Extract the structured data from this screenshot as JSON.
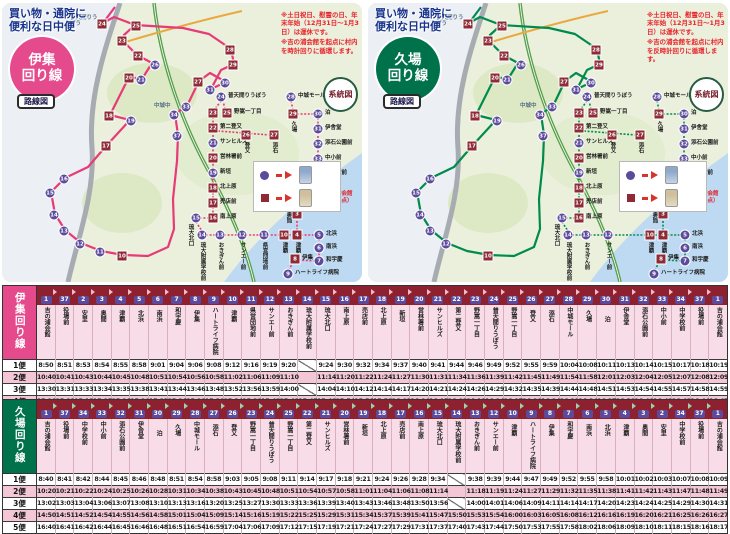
{
  "shared": {
    "tagline_line1": "買い物・通院に",
    "tagline_line2": "便利な日中便",
    "route_map_chip": "路線図",
    "system_chip": "系統図",
    "note_common": "※土日祝日、慰霊の日、年末年始（12月31日～1月3日）は運休です。"
  },
  "stops": {
    "1": "吉の浦会館",
    "2": "安里",
    "3": "奥間",
    "4": "津覇",
    "5": "北浜",
    "6": "南浜",
    "7": "和宇慶",
    "8": "伊集",
    "9": "ハートライフ病院",
    "10": "津覇",
    "11": "県営団地前",
    "12": "サンエー前",
    "13": "おきぎん前",
    "14": "琉大附属学校前",
    "15": "琉大北口",
    "16": "南上原",
    "17": "売店前",
    "18": "北上原",
    "19": "新垣",
    "20": "営林署前",
    "21": "サンヒルズ",
    "22": "第二登又",
    "23": "野嵩一丁目",
    "24": "普天間りうぼう",
    "25": "野嵩一丁目",
    "26": "登又",
    "27": "添石",
    "28": "中城モール",
    "29": "久場",
    "30": "泊",
    "31": "伊舎堂",
    "32": "添石公園前",
    "33": "中小前",
    "34": "中学校前",
    "37": "役場前"
  },
  "maps": [
    {
      "badge_line1": "伊集",
      "badge_line2": "回り線",
      "accent": "#e44a8c",
      "route_color": "#e73a77",
      "note_loop": "※吉の浦会館を起点に村内を時計回りに循環します。",
      "terminal": "吉の浦会館（起終点）",
      "geo_labels": [
        "普天間りうぼう",
        "中城中"
      ],
      "skip_stops": []
    },
    {
      "badge_line1": "久場",
      "badge_line2": "回り線",
      "accent": "#00724b",
      "route_color": "#008a4e",
      "note_loop": "※吉の浦会館を起点に村内を反時計回りに循環します。",
      "terminal": "吉の浦会館（起終点）",
      "geo_labels": [
        "普天間りうぼう",
        "中城中"
      ],
      "skip_stops": [
        "11"
      ]
    }
  ],
  "timetables": [
    {
      "line": "伊集回り線",
      "accent": "#e44a8c",
      "arrow_color": "#f2b9c6",
      "column_numbers": [
        "1",
        "37",
        "2",
        "3",
        "4",
        "5",
        "6",
        "7",
        "8",
        "9",
        "10",
        "11",
        "12",
        "13",
        "14",
        "15",
        "16",
        "17",
        "18",
        "19",
        "20",
        "21",
        "22",
        "23",
        "24",
        "25",
        "26",
        "27",
        "28",
        "29",
        "30",
        "31",
        "32",
        "33",
        "34",
        "37",
        "1"
      ],
      "trips": [
        {
          "label": "1便",
          "times": [
            "8:50",
            "8:51",
            "8:53",
            "8:54",
            "8:55",
            "8:58",
            "9:01",
            "9:04",
            "9:06",
            "9:08",
            "9:12",
            "9:16",
            "9:19",
            "9:20",
            "/",
            "9:24",
            "9:30",
            "9:32",
            "9:34",
            "9:37",
            "9:40",
            "9:41",
            "9:44",
            "9:46",
            "9:49",
            "9:52",
            "9:55",
            "9:59",
            "10:04",
            "10:08",
            "10:11",
            "10:13",
            "10:14",
            "10:15",
            "10:17",
            "10:18",
            "10:19"
          ]
        },
        {
          "label": "2便",
          "times": [
            "10:40",
            "10:41",
            "10:43",
            "10:44",
            "10:45",
            "10:48",
            "10:51",
            "10:54",
            "10:56",
            "10:58",
            "11:02",
            "11:06",
            "11:09",
            "11:10",
            "/",
            "11:14",
            "11:20",
            "11:22",
            "11:24",
            "11:27",
            "11:30",
            "11:31",
            "11:34",
            "11:36",
            "11:39",
            "11:42",
            "11:45",
            "11:49",
            "11:54",
            "11:58",
            "12:01",
            "12:03",
            "12:04",
            "12:05",
            "12:07",
            "12:08",
            "12:09"
          ]
        },
        {
          "label": "3便",
          "times": [
            "13:30",
            "13:31",
            "13:33",
            "13:34",
            "13:35",
            "13:38",
            "13:41",
            "13:44",
            "13:46",
            "13:48",
            "13:52",
            "13:56",
            "13:59",
            "14:00",
            "/",
            "14:04",
            "14:10",
            "14:12",
            "14:14",
            "14:17",
            "14:20",
            "14:21",
            "14:24",
            "14:26",
            "14:29",
            "14:32",
            "14:35",
            "14:39",
            "14:44",
            "14:48",
            "14:51",
            "14:53",
            "14:54",
            "14:55",
            "14:57",
            "14:58",
            "14:59"
          ]
        },
        {
          "label": "4便",
          "times": [
            "15:10",
            "15:11",
            "15:13",
            "15:15",
            "15:16",
            "15:20",
            "15:23",
            "15:26",
            "15:28",
            "15:30",
            "15:34",
            "15:38",
            "15:41",
            "15:42",
            "15:45",
            "15:48",
            "15:54",
            "15:56",
            "15:58",
            "16:01",
            "16:04",
            "16:05",
            "16:08",
            "16:11",
            "16:14",
            "16:17",
            "16:20",
            "16:24",
            "16:29",
            "16:34",
            "16:37",
            "16:39",
            "16:40",
            "16:41",
            "16:43",
            "16:44",
            "16:45"
          ]
        },
        {
          "label": "5便",
          "times": [
            "17:05",
            "17:06",
            "/",
            "/",
            "/",
            "/",
            "/",
            "/",
            "/",
            "/",
            "/",
            "17:11",
            "17:14",
            "17:15",
            "17:18",
            "17:21",
            "17:27",
            "17:29",
            "17:31",
            "17:34",
            "17:37",
            "17:39",
            "17:42",
            "17:45",
            "17:48",
            "17:51",
            "17:54",
            "17:58",
            "18:03",
            "18:08",
            "18:11",
            "18:13",
            "18:14",
            "18:15",
            "18:17",
            "18:18",
            "18:19"
          ]
        }
      ]
    },
    {
      "line": "久場回り線",
      "accent": "#00724b",
      "arrow_color": "#9ed1ae",
      "column_numbers": [
        "1",
        "37",
        "34",
        "33",
        "32",
        "31",
        "30",
        "29",
        "28",
        "27",
        "26",
        "23",
        "24",
        "25",
        "22",
        "21",
        "20",
        "19",
        "18",
        "17",
        "16",
        "15",
        "14",
        "13",
        "12",
        "10",
        "9",
        "8",
        "7",
        "6",
        "5",
        "4",
        "3",
        "2",
        "34",
        "37",
        "1"
      ],
      "trips": [
        {
          "label": "1便",
          "times": [
            "8:40",
            "8:41",
            "8:42",
            "8:44",
            "8:45",
            "8:46",
            "8:48",
            "8:51",
            "8:54",
            "8:58",
            "9:03",
            "9:05",
            "9:08",
            "9:11",
            "9:14",
            "9:17",
            "9:18",
            "9:21",
            "9:24",
            "9:26",
            "9:28",
            "9:34",
            "/",
            "9:38",
            "9:39",
            "9:44",
            "9:47",
            "9:49",
            "9:52",
            "9:55",
            "9:58",
            "10:01",
            "10:02",
            "10:03",
            "10:07",
            "10:08",
            "10:09"
          ]
        },
        {
          "label": "2便",
          "times": [
            "10:20",
            "10:21",
            "10:22",
            "10:24",
            "10:25",
            "10:26",
            "10:28",
            "10:31",
            "10:34",
            "10:38",
            "10:43",
            "10:45",
            "10:48",
            "10:51",
            "10:54",
            "10:57",
            "10:58",
            "11:01",
            "11:04",
            "11:06",
            "11:08",
            "11:14",
            "/",
            "11:18",
            "11:19",
            "11:24",
            "11:27",
            "11:29",
            "11:32",
            "11:35",
            "11:38",
            "11:41",
            "11:42",
            "11:43",
            "11:47",
            "11:48",
            "11:49"
          ]
        },
        {
          "label": "3便",
          "times": [
            "13:02",
            "13:03",
            "13:04",
            "13:06",
            "13:07",
            "13:08",
            "13:10",
            "13:13",
            "13:16",
            "13:20",
            "13:25",
            "13:27",
            "13:30",
            "13:33",
            "13:36",
            "13:39",
            "13:40",
            "13:43",
            "13:46",
            "13:48",
            "13:50",
            "13:56",
            "/",
            "14:00",
            "14:01",
            "14:06",
            "14:09",
            "14:11",
            "14:14",
            "14:17",
            "14:20",
            "14:23",
            "14:24",
            "14:25",
            "14:29",
            "14:30",
            "14:31"
          ]
        },
        {
          "label": "4便",
          "times": [
            "14:50",
            "14:51",
            "14:52",
            "14:54",
            "14:55",
            "14:56",
            "14:58",
            "15:01",
            "15:04",
            "15:09",
            "15:14",
            "15:16",
            "15:19",
            "15:22",
            "15:25",
            "15:29",
            "15:31",
            "15:34",
            "15:37",
            "15:39",
            "15:41",
            "15:47",
            "15:50",
            "15:53",
            "15:54",
            "16:00",
            "16:03",
            "16:05",
            "16:08",
            "16:12",
            "16:16",
            "16:19",
            "16:20",
            "16:21",
            "16:25",
            "16:26",
            "16:27"
          ]
        },
        {
          "label": "5便",
          "times": [
            "16:40",
            "16:41",
            "16:42",
            "16:44",
            "16:45",
            "16:46",
            "16:48",
            "16:51",
            "16:54",
            "16:59",
            "17:04",
            "17:06",
            "17:09",
            "17:12",
            "17:15",
            "17:19",
            "17:21",
            "17:24",
            "17:27",
            "17:29",
            "17:31",
            "17:37",
            "17:40",
            "17:43",
            "17:44",
            "17:50",
            "17:53",
            "17:55",
            "17:58",
            "18:02",
            "18:06",
            "18:09",
            "18:10",
            "18:11",
            "18:15",
            "18:16",
            "18:17"
          ]
        }
      ]
    }
  ]
}
